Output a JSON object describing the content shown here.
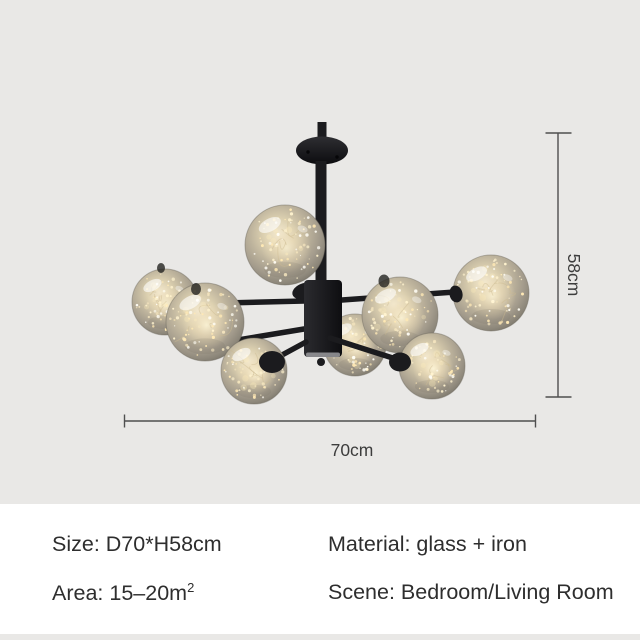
{
  "canvas": {
    "background_color": "#e9e8e6",
    "panel_background_color": "#ffffff"
  },
  "product": {
    "subject": "sputnik-chandelier-8-starry-glass-globes",
    "iron_color": "#1b1b1e",
    "glass_rim_color": "#7c776c",
    "glass_warm_color": "#f3e2bd",
    "sparkle_color": "#fff3cf",
    "wire_color": "#cbba90"
  },
  "annotations": {
    "height_label": "58cm",
    "width_label": "70cm",
    "line_color": "#4f4f4f",
    "label_color": "#3d3d3d"
  },
  "specs": {
    "size": "Size: D70*H58cm",
    "material": "Material: glass + iron",
    "area_base": "Area: 15–20m",
    "area_superscript": "2",
    "scene": "Scene: Bedroom/Living Room"
  }
}
